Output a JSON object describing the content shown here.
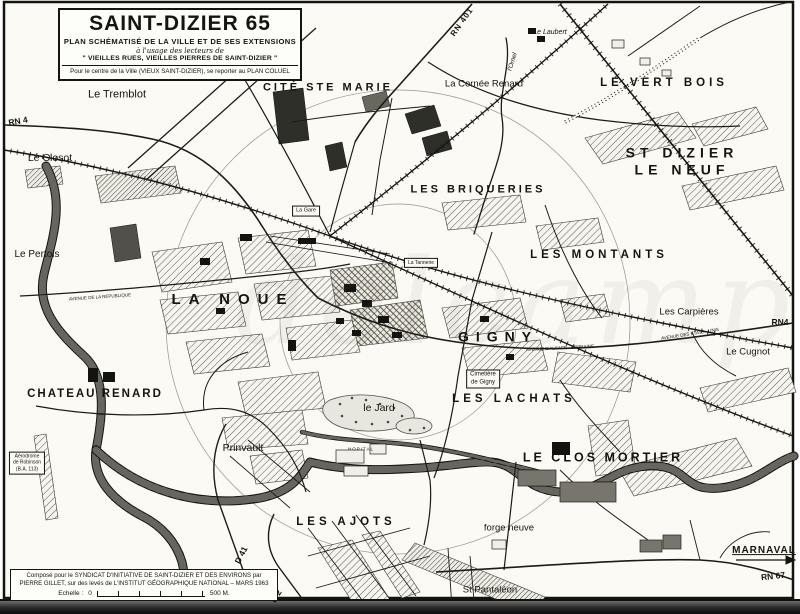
{
  "title_box": {
    "line1": "SAINT-DIZIER  65",
    "line2": "PLAN SCHÉMATISÉ DE LA VILLE ET DE SES EXTENSIONS",
    "line3": "à l'usage des lecteurs de",
    "line4": "\" VIEILLES RUES, VIEILLES PIERRES DE SAINT-DIZIER \"",
    "line5": "Pour le centre de la Ville (VIEUX SAINT-DIZIER), se reporter au PLAN COLUEL"
  },
  "credit_box": {
    "line1": "Composé pour le SYNDICAT D'INITIATIVE DE SAINT-DIZIER ET DES ENVIRONS par",
    "line2": "PIERRE GILLET, sur des levés de L'INSTITUT GÉOGRAPHIQUE NATIONAL – MARS 1963",
    "scale_label": "Echelle :",
    "scale_start": "0",
    "scale_end": "500 M."
  },
  "watermark": {
    "text": "delcampe",
    "color": "#6f6f66"
  },
  "map": {
    "ink": "#15150f",
    "paper": "#fbfaf5",
    "labels": [
      {
        "id": "rn-401",
        "text": "RN 401",
        "x": 462,
        "y": 22,
        "fs": 8,
        "b": 1,
        "rot": -55,
        "ls": 1
      },
      {
        "id": "le-laubert",
        "text": "Le Laubert",
        "x": 550,
        "y": 33,
        "fs": 7,
        "i": 1
      },
      {
        "id": "l-ornel",
        "text": "l'Ornel",
        "x": 513,
        "y": 62,
        "fs": 6.5,
        "i": 1,
        "rot": -72
      },
      {
        "id": "le-tremblot",
        "text": "Le Tremblot",
        "x": 117,
        "y": 95,
        "fs": 11
      },
      {
        "id": "cite-ste-marie",
        "text": "CITÉ STE MARIE",
        "x": 328,
        "y": 88,
        "fs": 11,
        "b": 1,
        "ls": 3
      },
      {
        "id": "la-cornee-renard",
        "text": "La Cornée Renard",
        "x": 484,
        "y": 84,
        "fs": 9.5
      },
      {
        "id": "le-vert-bois",
        "text": "LE VERT BOIS",
        "x": 664,
        "y": 84,
        "fs": 11.5,
        "b": 1,
        "ls": 4
      },
      {
        "id": "rn-4-west",
        "text": "RN 4",
        "x": 18,
        "y": 121,
        "fs": 8.5,
        "b": 1,
        "rot": -10
      },
      {
        "id": "st-dizier-le-neuf",
        "text": "ST DIZIER LE NEUF",
        "x": 682,
        "y": 161,
        "fs": 14,
        "b": 1,
        "ls": 5
      },
      {
        "id": "le-closot",
        "text": "Le Closot",
        "x": 50,
        "y": 158,
        "fs": 10.5
      },
      {
        "id": "les-briqueries",
        "text": "LES BRIQUERIES",
        "x": 478,
        "y": 190,
        "fs": 11,
        "b": 1,
        "ls": 3
      },
      {
        "id": "la-gare",
        "text": "La Gare",
        "x": 306,
        "y": 211,
        "fs": 5.5,
        "boxed": 1
      },
      {
        "id": "le-pertois",
        "text": "Le Pertois",
        "x": 37,
        "y": 255,
        "fs": 10
      },
      {
        "id": "les-montants",
        "text": "LES MONTANTS",
        "x": 599,
        "y": 256,
        "fs": 11.5,
        "b": 1,
        "ls": 4
      },
      {
        "id": "la-tannerie",
        "text": "La Tannerie",
        "x": 421,
        "y": 263,
        "fs": 5,
        "boxed": 1
      },
      {
        "id": "la-noue",
        "text": "LA NOUE",
        "x": 233,
        "y": 300,
        "fs": 15,
        "b": 1,
        "ls": 8
      },
      {
        "id": "les-carpieres",
        "text": "Les Carpières",
        "x": 689,
        "y": 312,
        "fs": 9.5
      },
      {
        "id": "rn-4-east",
        "text": "RN4",
        "x": 780,
        "y": 322,
        "fs": 8.5,
        "b": 1
      },
      {
        "id": "gigny",
        "text": "GIGNY",
        "x": 498,
        "y": 337,
        "fs": 14,
        "b": 1,
        "ls": 7
      },
      {
        "id": "le-cugnot",
        "text": "Le Cugnot",
        "x": 748,
        "y": 352,
        "fs": 9.5
      },
      {
        "id": "cimetiere-de-gigny",
        "text": "Cimetière\nde Gigny",
        "x": 483,
        "y": 379,
        "fs": 6,
        "boxed": 1
      },
      {
        "id": "les-lachats",
        "text": "LES LACHATS",
        "x": 514,
        "y": 400,
        "fs": 11.5,
        "b": 1,
        "ls": 4
      },
      {
        "id": "chateau-renard",
        "text": "CHATEAU RENARD",
        "x": 95,
        "y": 395,
        "fs": 11.5,
        "b": 1,
        "ls": 2
      },
      {
        "id": "le-jard",
        "text": "le Jard",
        "x": 379,
        "y": 408,
        "fs": 10.5
      },
      {
        "id": "prinvault",
        "text": "Prinvault",
        "x": 243,
        "y": 448,
        "fs": 10.5
      },
      {
        "id": "aerodrome-robinson",
        "text": "Aérodrome\nde Robinson\n(B.A. 113)",
        "x": 27,
        "y": 463,
        "fs": 5,
        "boxed": 1
      },
      {
        "id": "hopital",
        "text": "HOPITAL",
        "x": 361,
        "y": 449,
        "fs": 4.5,
        "ls": 1
      },
      {
        "id": "le-clos-mortier",
        "text": "LE CLOS MORTIER",
        "x": 603,
        "y": 458,
        "fs": 12.5,
        "b": 1,
        "ls": 3
      },
      {
        "id": "forge-neuve",
        "text": "forge neuve",
        "x": 509,
        "y": 528,
        "fs": 9.5
      },
      {
        "id": "les-ajots",
        "text": "LES AJOTS",
        "x": 346,
        "y": 523,
        "fs": 11.5,
        "b": 1,
        "ls": 4
      },
      {
        "id": "d-41",
        "text": "D 41",
        "x": 241,
        "y": 555,
        "fs": 8.5,
        "b": 1,
        "rot": -63
      },
      {
        "id": "marnaval",
        "text": "MARNAVAL",
        "x": 764,
        "y": 551,
        "fs": 10,
        "b": 1,
        "ls": 1,
        "u": 1
      },
      {
        "id": "rn-67",
        "text": "RN 67",
        "x": 773,
        "y": 576,
        "fs": 8.5,
        "b": 1,
        "rot": -6
      },
      {
        "id": "st-pantaleon",
        "text": "St Pantaléon",
        "x": 490,
        "y": 590,
        "fs": 9.5
      },
      {
        "id": "d-2",
        "text": "D 2",
        "x": 276,
        "y": 596,
        "fs": 8.5,
        "b": 1,
        "rot": -58
      },
      {
        "id": "avenue-alsace-lorraine",
        "text": "AVENUE  D'ALSACE - LORRAINE",
        "x": 560,
        "y": 348,
        "fs": 4.5,
        "rot": -3
      },
      {
        "id": "avenue-etats-unis",
        "text": "AVENUE  DES  ÉTATS - UNIS",
        "x": 690,
        "y": 334,
        "fs": 4.5,
        "rot": -9
      },
      {
        "id": "avenue-republique",
        "text": "AVENUE  DE  LA  RÉPUBLIQUE",
        "x": 100,
        "y": 297,
        "fs": 4.5,
        "rot": -4
      }
    ]
  }
}
